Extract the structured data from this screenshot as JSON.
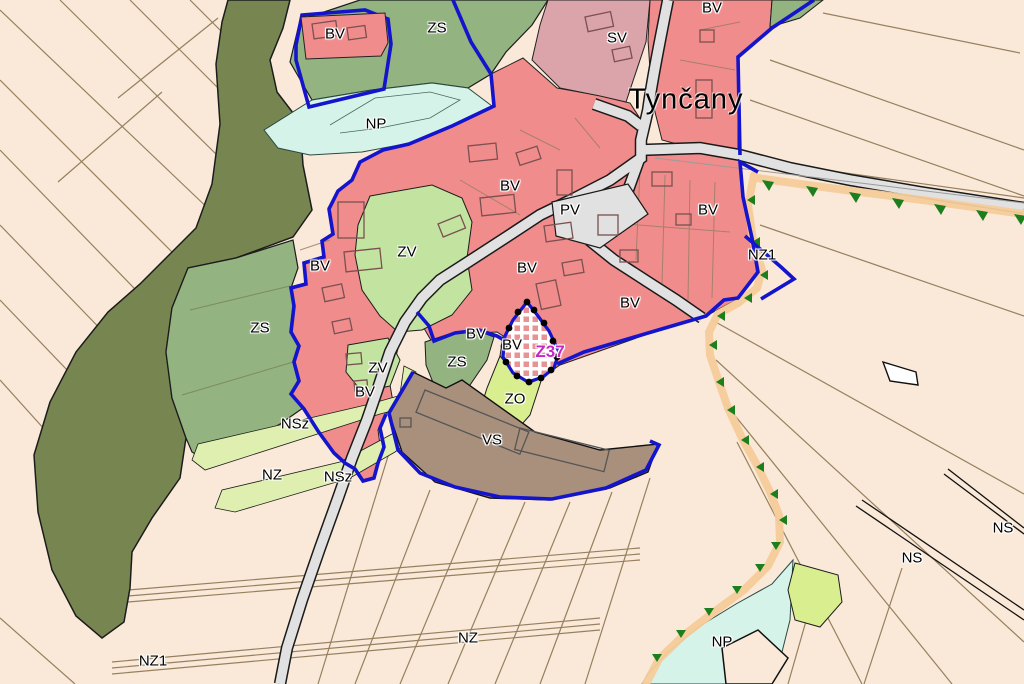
{
  "map": {
    "town_label": "Tynčany",
    "town_label_pos": {
      "x": 686,
      "y": 100
    },
    "labels": [
      {
        "text": "BV",
        "x": 335,
        "y": 34
      },
      {
        "text": "BV",
        "x": 712,
        "y": 8
      },
      {
        "text": "BV",
        "x": 510,
        "y": 186
      },
      {
        "text": "BV",
        "x": 708,
        "y": 210
      },
      {
        "text": "BV",
        "x": 320,
        "y": 266
      },
      {
        "text": "BV",
        "x": 527,
        "y": 268
      },
      {
        "text": "BV",
        "x": 630,
        "y": 303
      },
      {
        "text": "BV",
        "x": 476,
        "y": 334
      },
      {
        "text": "BV",
        "x": 512,
        "y": 345
      },
      {
        "text": "BV",
        "x": 365,
        "y": 392
      },
      {
        "text": "SV",
        "x": 617,
        "y": 38
      },
      {
        "text": "ZS",
        "x": 437,
        "y": 28
      },
      {
        "text": "ZS",
        "x": 260,
        "y": 328
      },
      {
        "text": "ZS",
        "x": 457,
        "y": 362
      },
      {
        "text": "NP",
        "x": 376,
        "y": 124
      },
      {
        "text": "NP",
        "x": 722,
        "y": 642
      },
      {
        "text": "ZV",
        "x": 407,
        "y": 252
      },
      {
        "text": "ZV",
        "x": 378,
        "y": 368
      },
      {
        "text": "PV",
        "x": 570,
        "y": 210
      },
      {
        "text": "ZO",
        "x": 515,
        "y": 399
      },
      {
        "text": "VS",
        "x": 492,
        "y": 440
      },
      {
        "text": "NSz",
        "x": 295,
        "y": 424
      },
      {
        "text": "NSz",
        "x": 338,
        "y": 477
      },
      {
        "text": "NZ",
        "x": 272,
        "y": 475
      },
      {
        "text": "NZ",
        "x": 468,
        "y": 638
      },
      {
        "text": "NZ1",
        "x": 762,
        "y": 255
      },
      {
        "text": "NZ1",
        "x": 153,
        "y": 661
      },
      {
        "text": "NS",
        "x": 912,
        "y": 558
      },
      {
        "text": "NS",
        "x": 1003,
        "y": 528
      },
      {
        "text": "Z37",
        "x": 550,
        "y": 352,
        "kind": "dev"
      }
    ],
    "colors": {
      "bv": "#F18C8C",
      "sv": "#DBA4AA",
      "zs": "#93B381",
      "zv": "#C3E3A0",
      "np": "#D6F3EA",
      "zo": "#D9EE8F",
      "nsz": "#DEEFB0",
      "vs": "#A8907C",
      "nz": "#FAE9D8",
      "forest": "#778650",
      "road": "#E1E1E1",
      "boundary": "#1414CC",
      "corridor": "#F6CC9B",
      "triangle": "#1C7E1C",
      "devcolor": "#C428C4",
      "parcel": "#96805F"
    }
  }
}
